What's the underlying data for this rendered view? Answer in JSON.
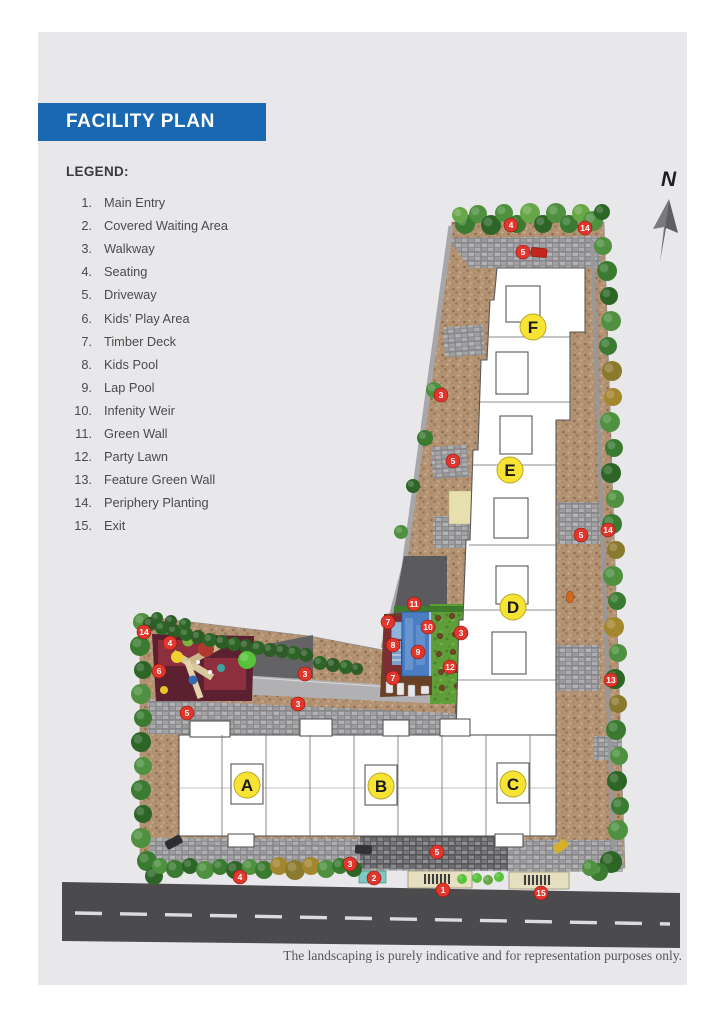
{
  "title": "FACILITY PLAN",
  "legend": {
    "title": "LEGEND:",
    "items": [
      {
        "num": "1.",
        "label": "Main Entry"
      },
      {
        "num": "2.",
        "label": "Covered Waiting Area"
      },
      {
        "num": "3.",
        "label": "Walkway"
      },
      {
        "num": "4.",
        "label": "Seating"
      },
      {
        "num": "5.",
        "label": "Driveway"
      },
      {
        "num": "6.",
        "label": "Kids’ Play Area"
      },
      {
        "num": "7.",
        "label": "Timber Deck"
      },
      {
        "num": "8.",
        "label": "Kids Pool"
      },
      {
        "num": "9.",
        "label": "Lap Pool"
      },
      {
        "num": "10.",
        "label": "Infenity Weir"
      },
      {
        "num": "11.",
        "label": "Green Wall"
      },
      {
        "num": "12.",
        "label": "Party Lawn"
      },
      {
        "num": "13.",
        "label": "Feature Green Wall"
      },
      {
        "num": "14.",
        "label": "Periphery Planting"
      },
      {
        "num": "15.",
        "label": "Exit"
      }
    ]
  },
  "compass": {
    "label": "N"
  },
  "plan": {
    "building_labels": [
      {
        "id": "A",
        "x": 247,
        "y": 785
      },
      {
        "id": "B",
        "x": 381,
        "y": 786
      },
      {
        "id": "C",
        "x": 513,
        "y": 784
      },
      {
        "id": "D",
        "x": 513,
        "y": 607
      },
      {
        "id": "E",
        "x": 510,
        "y": 470
      },
      {
        "id": "F",
        "x": 533,
        "y": 327
      }
    ],
    "markers": [
      {
        "n": "4",
        "x": 511,
        "y": 225
      },
      {
        "n": "14",
        "x": 585,
        "y": 228
      },
      {
        "n": "5",
        "x": 523,
        "y": 252
      },
      {
        "n": "3",
        "x": 441,
        "y": 395
      },
      {
        "n": "5",
        "x": 453,
        "y": 461
      },
      {
        "n": "14",
        "x": 608,
        "y": 530
      },
      {
        "n": "5",
        "x": 581,
        "y": 535
      },
      {
        "n": "13",
        "x": 611,
        "y": 680
      },
      {
        "n": "11",
        "x": 414,
        "y": 604
      },
      {
        "n": "7",
        "x": 388,
        "y": 622
      },
      {
        "n": "10",
        "x": 428,
        "y": 627
      },
      {
        "n": "8",
        "x": 393,
        "y": 645
      },
      {
        "n": "9",
        "x": 418,
        "y": 652
      },
      {
        "n": "3",
        "x": 461,
        "y": 633
      },
      {
        "n": "12",
        "x": 450,
        "y": 667
      },
      {
        "n": "7",
        "x": 393,
        "y": 678
      },
      {
        "n": "14",
        "x": 144,
        "y": 632
      },
      {
        "n": "4",
        "x": 170,
        "y": 643
      },
      {
        "n": "6",
        "x": 159,
        "y": 671
      },
      {
        "n": "3",
        "x": 305,
        "y": 674
      },
      {
        "n": "3",
        "x": 298,
        "y": 704
      },
      {
        "n": "5",
        "x": 187,
        "y": 713
      },
      {
        "n": "5",
        "x": 437,
        "y": 852
      },
      {
        "n": "3",
        "x": 350,
        "y": 864
      },
      {
        "n": "4",
        "x": 240,
        "y": 877
      },
      {
        "n": "2",
        "x": 374,
        "y": 878
      },
      {
        "n": "1",
        "x": 443,
        "y": 890
      },
      {
        "n": "15",
        "x": 541,
        "y": 893
      }
    ]
  },
  "footer": {
    "disclaimer": "The landscaping is purely indicative and for representation purposes only."
  },
  "colors": {
    "accent_blue": "#1a68b2",
    "page_gray": "#e8e8ea",
    "legend_text": "#4b4b4d",
    "marker_red": "#e2352b",
    "marker_red_edge": "#8c1410",
    "label_yellow": "#f6e334",
    "label_yellow_edge": "#b8a623",
    "road_gray": "#4b4b4d",
    "pool_blue": "#4a7dc2"
  }
}
